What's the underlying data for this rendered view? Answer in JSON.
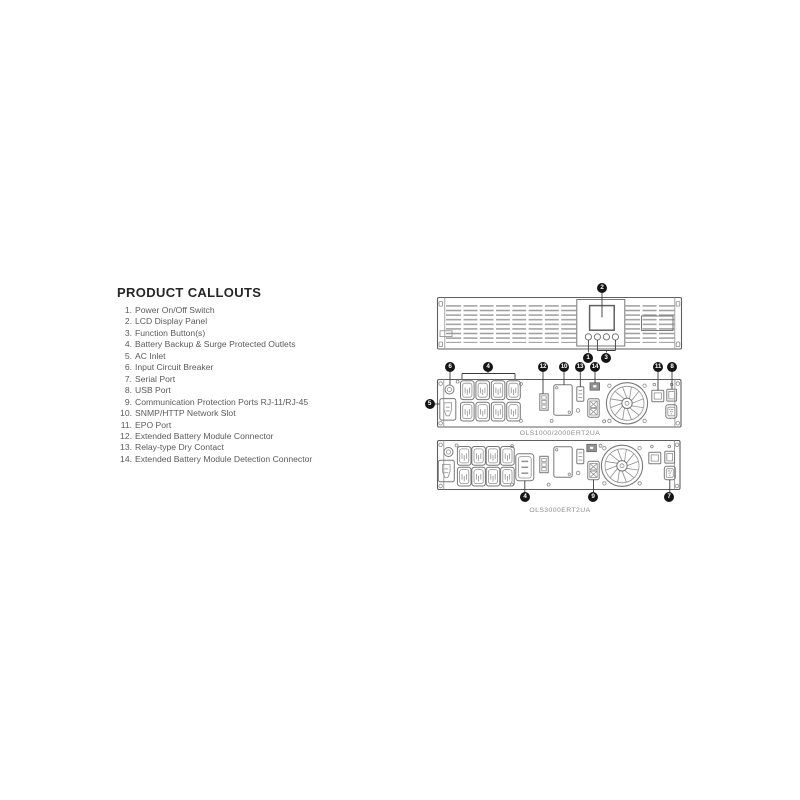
{
  "callouts_section": {
    "title": "PRODUCT CALLOUTS",
    "items": [
      {
        "num": "1.",
        "label": "Power On/Off Switch"
      },
      {
        "num": "2.",
        "label": "LCD Display Panel"
      },
      {
        "num": "3.",
        "label": "Function Button(s)"
      },
      {
        "num": "4.",
        "label": "Battery Backup & Surge Protected Outlets"
      },
      {
        "num": "5.",
        "label": "AC Inlet"
      },
      {
        "num": "6.",
        "label": "Input Circuit Breaker"
      },
      {
        "num": "7.",
        "label": "Serial Port"
      },
      {
        "num": "8.",
        "label": "USB Port"
      },
      {
        "num": "9.",
        "label": "Communication Protection Ports RJ-11/RJ-45"
      },
      {
        "num": "10.",
        "label": "SNMP/HTTP Network Slot"
      },
      {
        "num": "11.",
        "label": "EPO Port"
      },
      {
        "num": "12.",
        "label": "Extended Battery Module Connector"
      },
      {
        "num": "13.",
        "label": "Relay-type Dry Contact"
      },
      {
        "num": "14.",
        "label": "Extended Battery Module Detection Connector"
      }
    ]
  },
  "diagrams": {
    "front_panel": {
      "badges": [
        {
          "n": "2"
        },
        {
          "n": "1"
        },
        {
          "n": "3"
        }
      ]
    },
    "rear_panel_ols1000_2000": {
      "model_label": "OLS1000/2000ERT2UA",
      "badges": [
        {
          "n": "6"
        },
        {
          "n": "4"
        },
        {
          "n": "12"
        },
        {
          "n": "10"
        },
        {
          "n": "13"
        },
        {
          "n": "14"
        },
        {
          "n": "11"
        },
        {
          "n": "8"
        },
        {
          "n": "5"
        }
      ]
    },
    "rear_panel_ols3000": {
      "model_label": "OLS3000ERT2UA",
      "badges": [
        {
          "n": "4"
        },
        {
          "n": "9"
        },
        {
          "n": "7"
        }
      ]
    }
  },
  "colors": {
    "badge": "#141414",
    "line_art": "#7b7b7b",
    "list_text": "#5a5a5a",
    "heading_text": "#262626",
    "background": "#ffffff"
  }
}
